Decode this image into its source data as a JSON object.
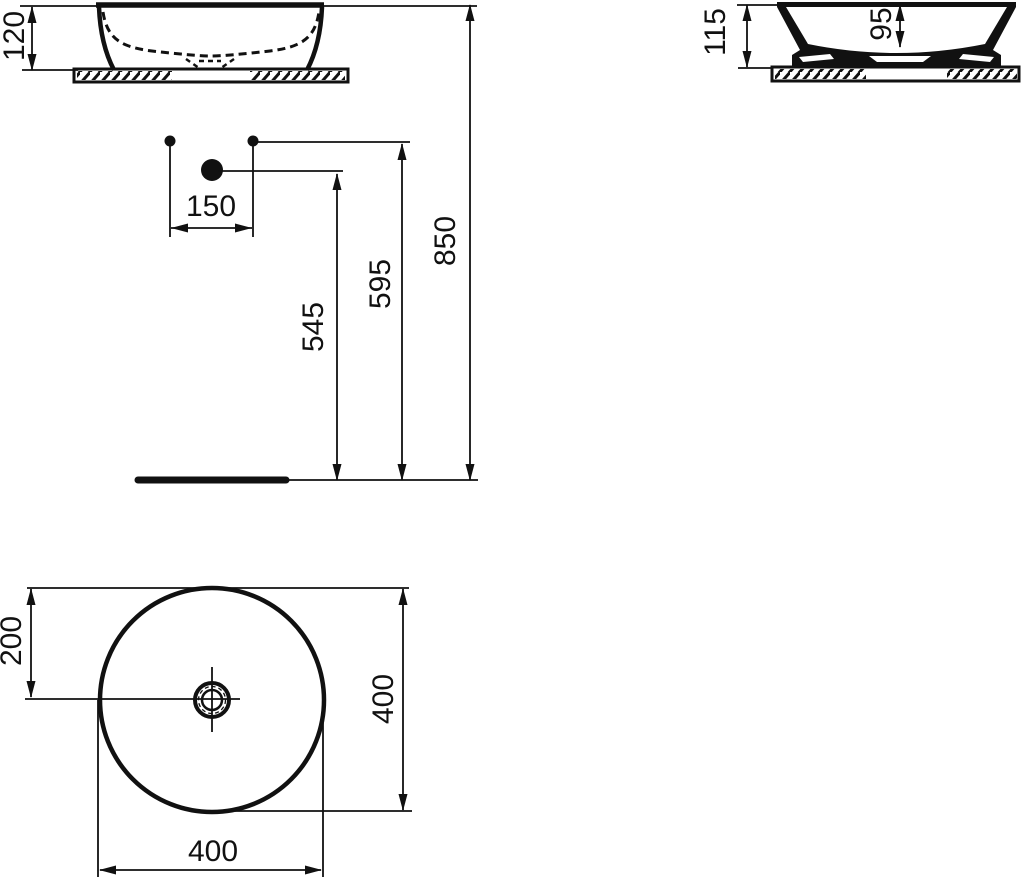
{
  "colors": {
    "line": "#111111",
    "background": "#ffffff"
  },
  "views": {
    "front": {
      "height": "120"
    },
    "side": {
      "overall_height": "115",
      "bowl_depth": "95"
    },
    "installation": {
      "hole_spacing": "150",
      "drain_height": "545",
      "supply_height": "595",
      "overall_height": "850"
    },
    "plan": {
      "center_offset": "200",
      "diameter_side": "400",
      "diameter_front": "400"
    }
  }
}
